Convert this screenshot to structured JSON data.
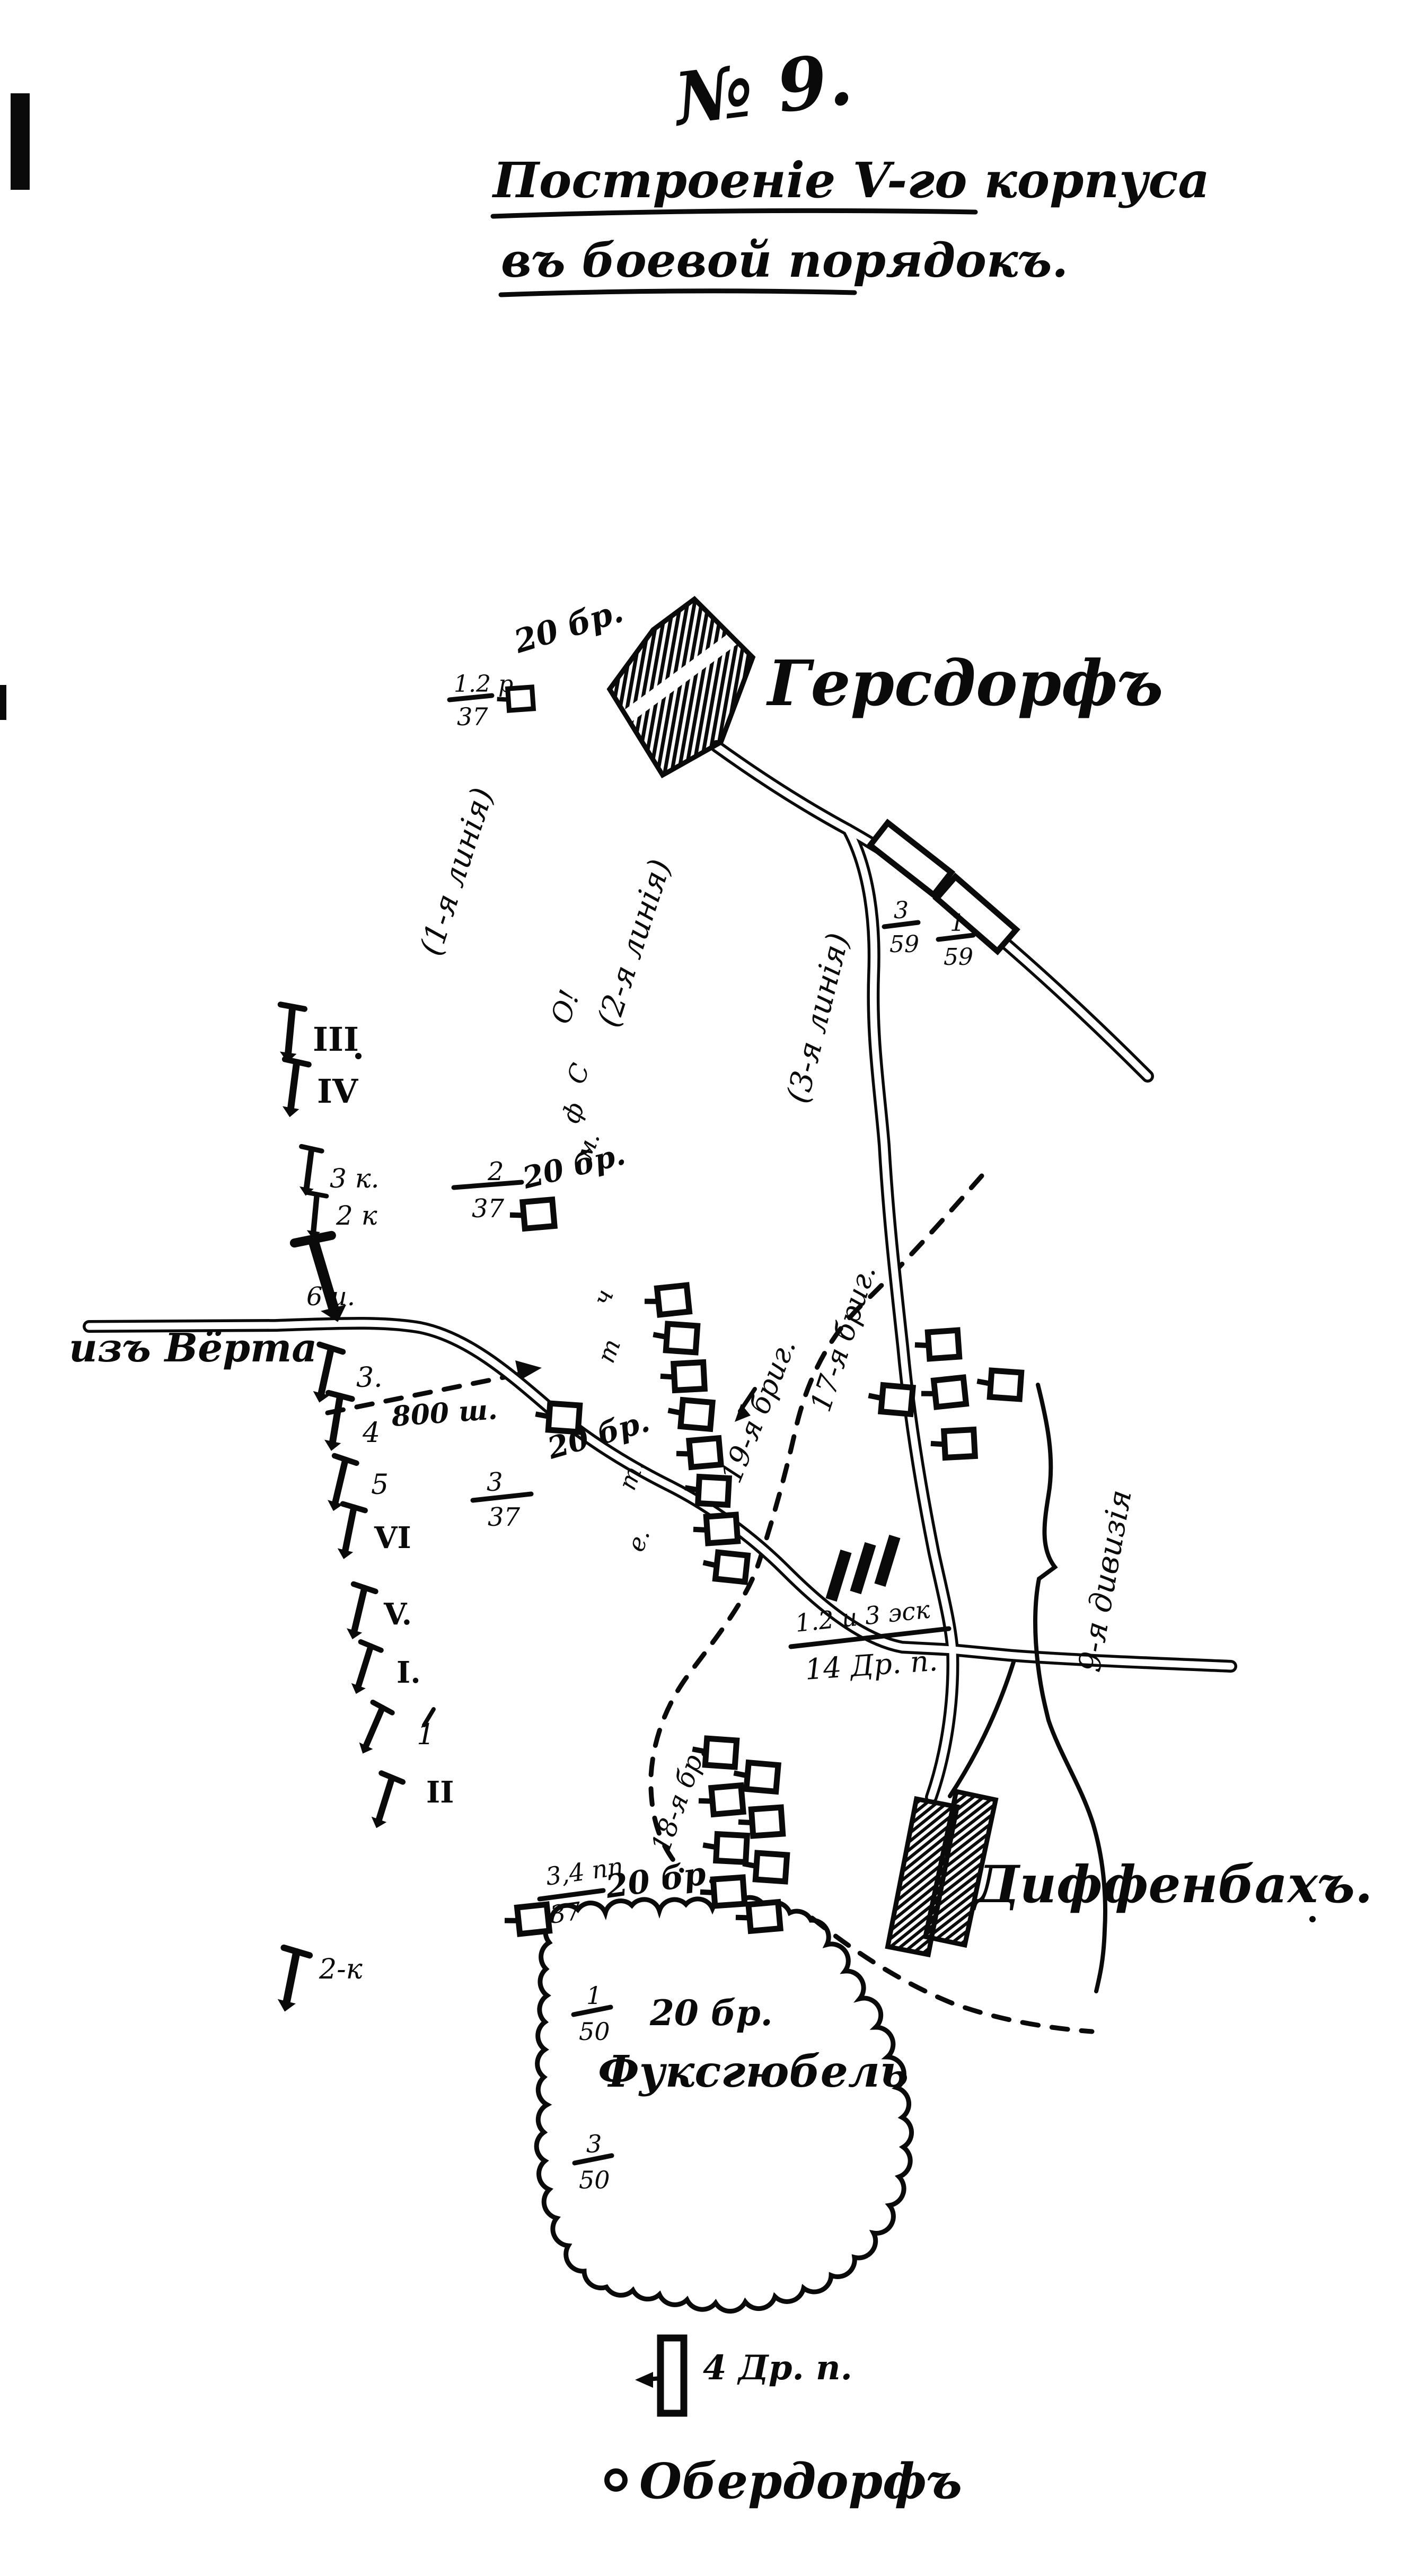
{
  "map": {
    "number": "№ 9.",
    "title_line1": "Построеніе V-го корпуса",
    "title_line2": "въ боевой порядокъ.",
    "colors": {
      "ink": "#0a0a0a",
      "paper": "#ffffff"
    },
    "places": {
      "gersdorf": "Герсдорфъ",
      "dieffenbach": "Диффенбахъ.",
      "fuchshuebel": "Фуксгюбель",
      "oberdorf": "Обердорфъ",
      "from_woerth": "изъ Вёрта"
    },
    "battle_lines": {
      "first": "(1-я линія)",
      "second": "(2-я линія)",
      "third": "(3-я линія)"
    },
    "units": {
      "gersdorf_brigade": "20 бр.",
      "gersdorf_regiment": {
        "num": "1.2 р.",
        "den": "37"
      },
      "march_column_1": {
        "num": "3",
        "den": "59"
      },
      "march_column_2": {
        "num": "1",
        "den": "59"
      },
      "second_line": {
        "num": "2",
        "den": "37",
        "brigade": "20 бр."
      },
      "first_line": {
        "num": "3",
        "den": "37",
        "brigade": "20 бр."
      },
      "brigade17": "17-я бриг.",
      "brigade19": "19-я бриг.",
      "brigade18": "18-я бр.",
      "division9": "9-я дивизія",
      "dragoons14": {
        "num": "1.2 и 3 эск",
        "den": "14 Др. п."
      },
      "infantry37": {
        "num": "3,4 пп",
        "den": "37",
        "brigade": "20 бр."
      },
      "fuchs_bn1": {
        "num": "1",
        "den": "50"
      },
      "fuchs_brigade": "20 бр.",
      "fuchs_bn3": {
        "num": "3",
        "den": "50"
      },
      "dragoons4": "4 Др. п.",
      "distance": "800 ш."
    },
    "left_markers": [
      "III",
      "IV",
      "3 к.",
      "2 к",
      "6 и.",
      "3.",
      "4",
      "5",
      "VI",
      "V.",
      "I.",
      "1",
      "II",
      "2-к"
    ],
    "diagonal_letters": [
      "О!",
      "С",
      "ф",
      "м.",
      "ч",
      "т",
      "т.",
      "е."
    ]
  }
}
